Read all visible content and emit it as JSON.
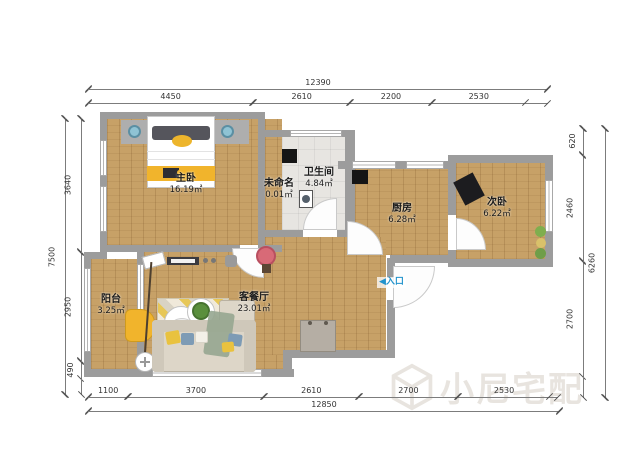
{
  "rooms": [
    {
      "id": "master-bedroom",
      "name": "主卧",
      "area": "16.19㎡"
    },
    {
      "id": "unnamed",
      "name": "未命名",
      "area": "0.01㎡"
    },
    {
      "id": "bathroom",
      "name": "卫生间",
      "area": "4.84㎡"
    },
    {
      "id": "kitchen",
      "name": "厨房",
      "area": "6.28㎡"
    },
    {
      "id": "second-bedroom",
      "name": "次卧",
      "area": "6.22㎡"
    },
    {
      "id": "balcony",
      "name": "阳台",
      "area": "3.25㎡"
    },
    {
      "id": "living-dining",
      "name": "客餐厅",
      "area": "23.01㎡"
    }
  ],
  "entrance": {
    "marker": "◀",
    "label": "入口"
  },
  "watermark": {
    "text": "小尼宅配"
  },
  "dimensions": {
    "top": {
      "total": [
        {
          "mm": 12390,
          "label": "12390"
        }
      ],
      "segments": [
        {
          "mm": 4450,
          "label": "4450"
        },
        {
          "mm": 2610,
          "label": "2610"
        },
        {
          "mm": 2200,
          "label": "2200"
        },
        {
          "mm": 2530,
          "label": "2530"
        },
        {
          "mm": 600,
          "label": ""
        }
      ]
    },
    "bottom": {
      "total": [
        {
          "mm": 12850,
          "label": "12850"
        }
      ],
      "segments": [
        {
          "mm": 1100,
          "label": "1100"
        },
        {
          "mm": 3700,
          "label": "3700"
        },
        {
          "mm": 2610,
          "label": "2610"
        },
        {
          "mm": 2700,
          "label": "2700"
        },
        {
          "mm": 2530,
          "label": "2530"
        },
        {
          "mm": 210,
          "label": ""
        }
      ]
    },
    "left": {
      "total": [
        {
          "mm": 7500,
          "label": "7500"
        }
      ],
      "segments": [
        {
          "mm": 3640,
          "label": "3640"
        },
        {
          "mm": 2950,
          "label": "2950"
        },
        {
          "mm": 490,
          "label": "490"
        },
        {
          "mm": 420,
          "label": ""
        }
      ]
    },
    "right": {
      "total": [
        {
          "mm": 6260,
          "label": "6260"
        }
      ],
      "segments": [
        {
          "mm": 620,
          "label": "620"
        },
        {
          "mm": 2460,
          "label": "2460"
        },
        {
          "mm": 2700,
          "label": "2700"
        },
        {
          "mm": 480,
          "label": ""
        }
      ]
    }
  },
  "colors": {
    "wall": "#9c9c9c",
    "wood_floor": "#c7a167",
    "tile_floor": "#e7e5e1",
    "accent_yellow": "#f1b42c",
    "entrance_blue": "#2293cc",
    "watermark": "#e4e0da"
  }
}
